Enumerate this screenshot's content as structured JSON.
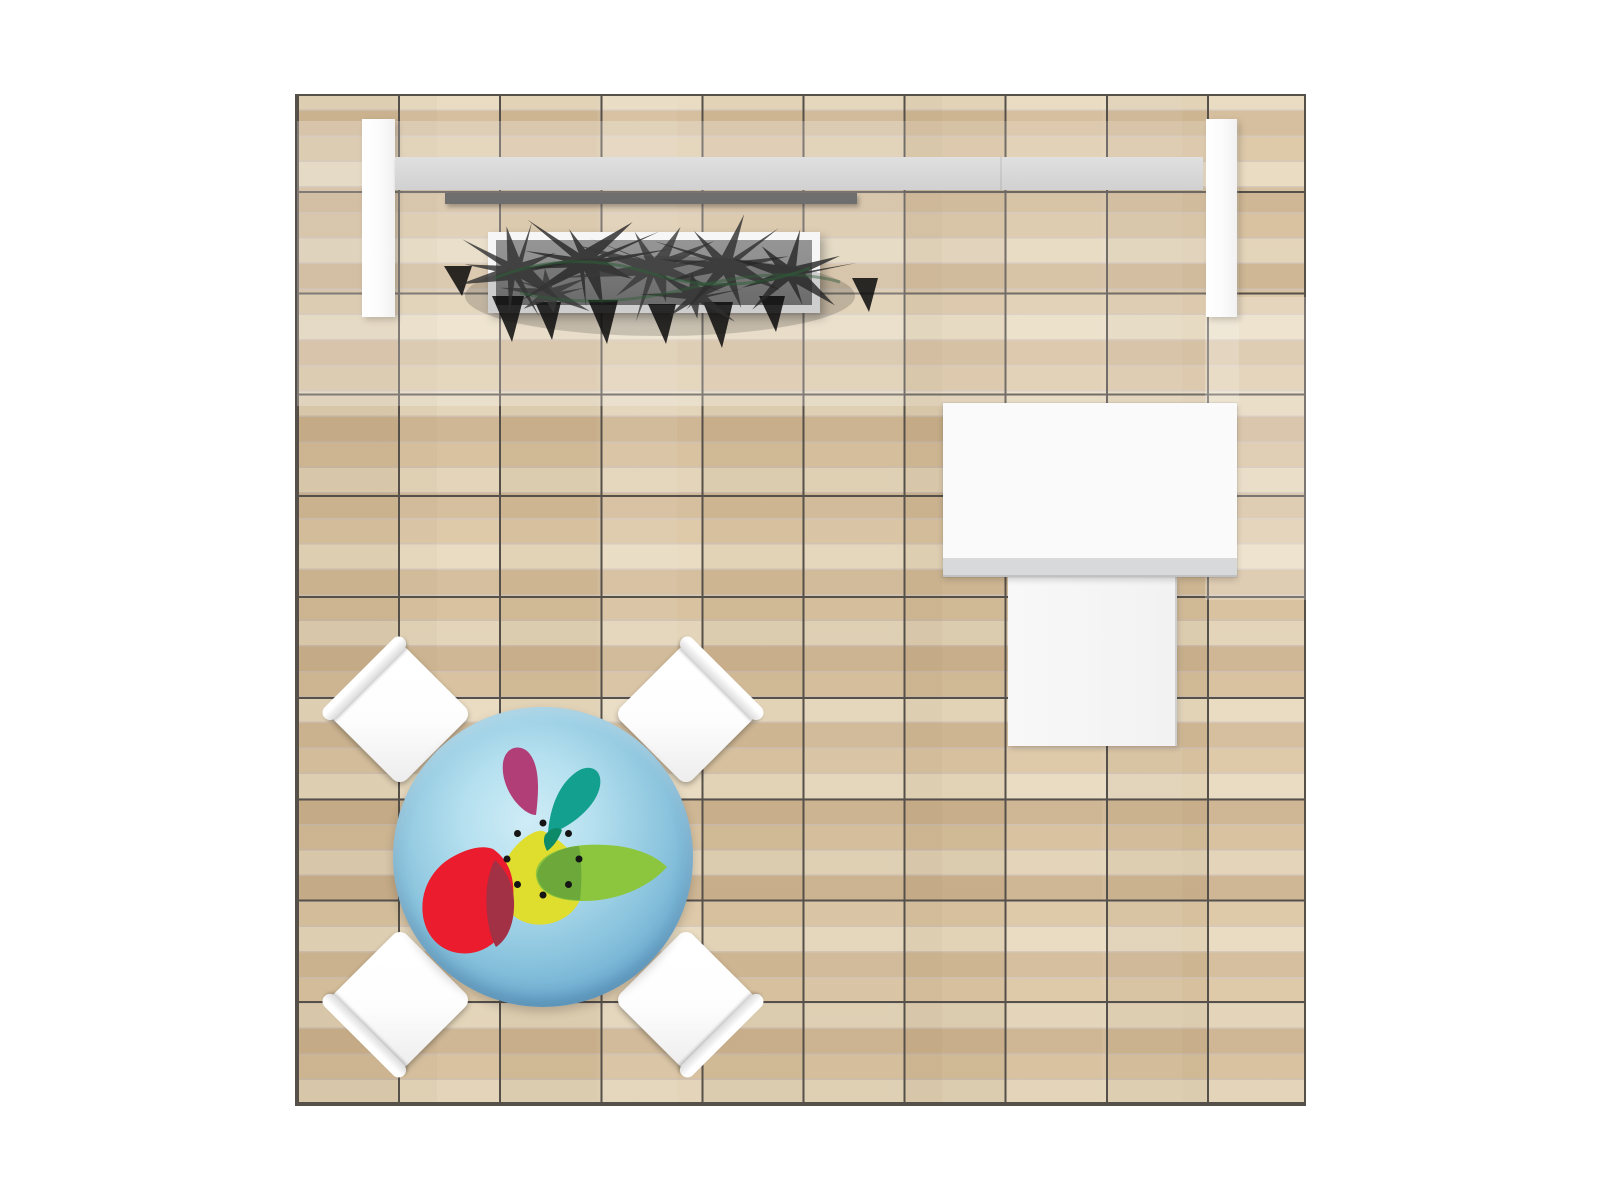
{
  "meta": {
    "description": "Top-down plan view of a trade-show booth on a 10x10 wood tile floor: backwall with two pillars, gray beam and shelf, hedge planter, reception counter with side table, and a round logo table with four chairs",
    "canvas": {
      "width": 1600,
      "height": 1200
    }
  },
  "colors": {
    "plank_a": "#e6d7ba",
    "plank_b": "#d9c29e",
    "plank_c": "#cfb691",
    "grid_line": "#56504a",
    "pillar": "#fbfbfb",
    "beam": "#d9d9d9",
    "shelf": "#6e6e6e",
    "planter_frame": "#f6f6f6",
    "planter_soil": "#8d8d8d",
    "plant_dark": "#2e2e2e",
    "plant_green": "#2e5e38",
    "counter": "#fafafa",
    "counter_strip": "#d8d9da",
    "side_table": "#f8f8f8",
    "chair": "#fdfdfd",
    "tbl_2": "#b5e0ef",
    "tbl_5": "#3e7dab",
    "logo_yellow": "#dfdd2e",
    "logo_red": "#ea1c2d",
    "logo_crimson": "#a23146",
    "logo_green": "#8cc63e",
    "logo_olive": "#6aa83a",
    "logo_teal": "#14a08e",
    "logo_teal_dark": "#0d8a68",
    "logo_magenta": "#b13e77",
    "logo_dot": "#151515"
  },
  "scene": {
    "floor": {
      "rect": [
        295,
        94,
        1011,
        1012
      ],
      "grid_cols": 10,
      "grid_rows": 10
    },
    "backwall": {
      "pillar_left": {
        "rect": [
          362,
          119,
          33,
          198
        ]
      },
      "pillar_right": {
        "rect": [
          1206,
          119,
          31,
          198
        ]
      },
      "beam": {
        "rect": [
          395,
          157,
          808,
          33
        ]
      },
      "shelf": {
        "rect": [
          445,
          193,
          412,
          11
        ]
      }
    },
    "planter": {
      "rect": [
        488,
        232,
        332,
        81
      ],
      "svg_origin": [
        440,
        178
      ],
      "svg_size": [
        440,
        175
      ],
      "bursts": [
        {
          "cx": 75,
          "cy": 92,
          "r": 68,
          "spikes": 10,
          "seed": 11
        },
        {
          "cx": 145,
          "cy": 84,
          "r": 76,
          "spikes": 11,
          "seed": 23
        },
        {
          "cx": 215,
          "cy": 90,
          "r": 80,
          "spikes": 11,
          "seed": 37
        },
        {
          "cx": 285,
          "cy": 88,
          "r": 76,
          "spikes": 10,
          "seed": 51
        },
        {
          "cx": 350,
          "cy": 95,
          "r": 66,
          "spikes": 9,
          "seed": 67
        },
        {
          "cx": 110,
          "cy": 115,
          "r": 46,
          "spikes": 8,
          "seed": 73
        },
        {
          "cx": 255,
          "cy": 118,
          "r": 50,
          "spikes": 8,
          "seed": 89
        }
      ],
      "shadow_spikes": [
        [
          68,
          118,
          16,
          46
        ],
        [
          108,
          124,
          13,
          38
        ],
        [
          163,
          122,
          15,
          44
        ],
        [
          222,
          126,
          14,
          40
        ],
        [
          278,
          124,
          15,
          46
        ],
        [
          332,
          118,
          13,
          36
        ],
        [
          18,
          88,
          14,
          30
        ],
        [
          425,
          100,
          13,
          34
        ]
      ]
    },
    "counter": {
      "rect": [
        943,
        403,
        294,
        174
      ]
    },
    "side_table": {
      "rect": [
        1008,
        577,
        169,
        169
      ]
    },
    "meeting_table": {
      "rect": [
        393,
        707,
        300,
        300
      ],
      "logo_dots": {
        "count": 8,
        "ring_radius": 36,
        "dot_radius": 3.5,
        "cx": 150,
        "cy": 152
      }
    },
    "chairs": [
      {
        "id": "chair-nw",
        "center": [
          400,
          714
        ]
      },
      {
        "id": "chair-ne",
        "center": [
          686,
          714
        ]
      },
      {
        "id": "chair-sw",
        "center": [
          400,
          1000
        ]
      },
      {
        "id": "chair-se",
        "center": [
          686,
          1000
        ]
      }
    ]
  }
}
